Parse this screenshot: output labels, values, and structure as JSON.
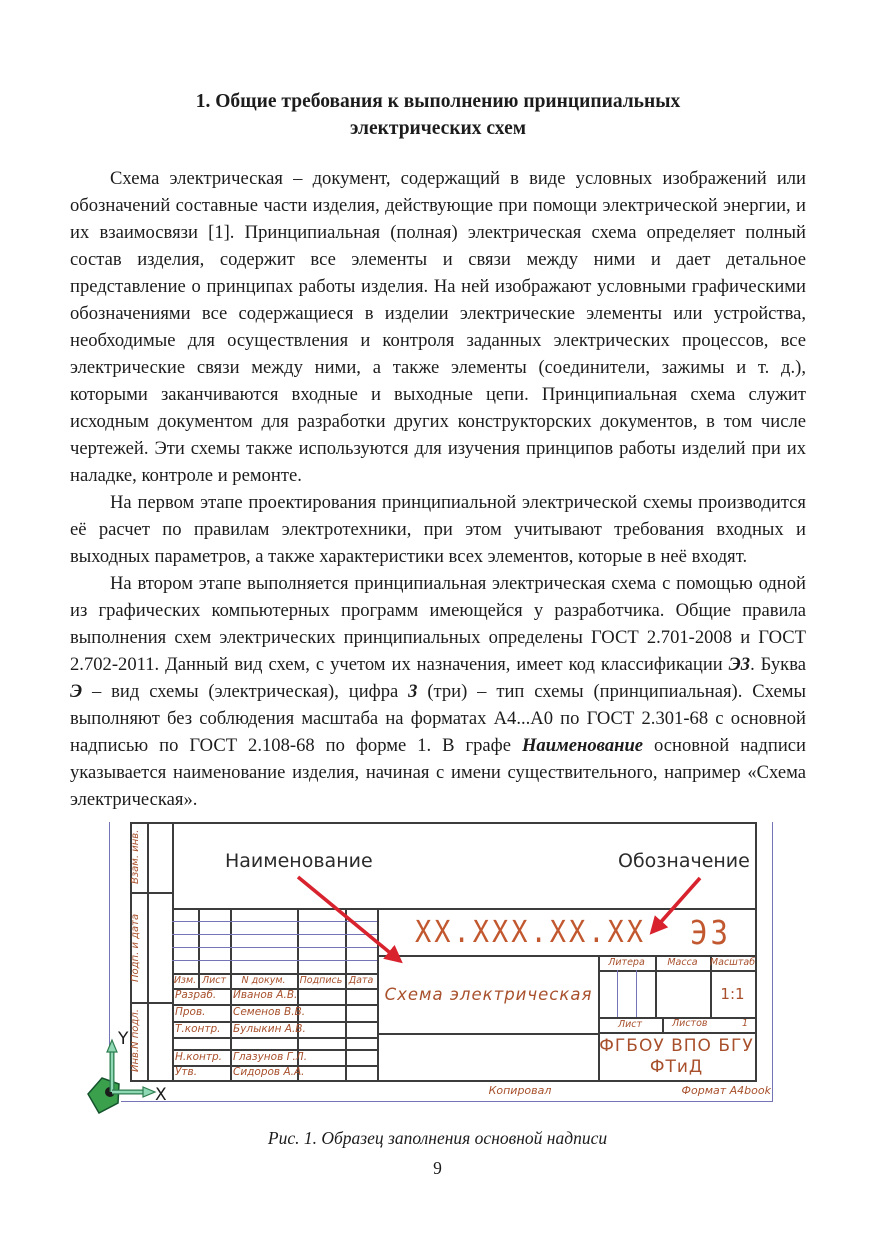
{
  "page": {
    "number": "9"
  },
  "title": {
    "line1": "1. Общие требования к выполнению принципиальных",
    "line2": "электрических схем"
  },
  "paragraphs": {
    "p1": "Схема электрическая – документ, содержащий в виде условных изображений или обозначений составные части изделия, действующие при помощи электрической энергии, и их взаимосвязи [1]. Принципиальная (полная) электрическая схема определяет полный состав изделия, содержит все элементы и связи между ними и дает детальное представление о принципах работы изделия. На ней изображают условными графическими обозначениями все содержащиеся в изделии электрические элементы или устройства, необходимые для осуществления и контроля заданных электрических процессов, все электрические связи между ними, а также элементы (соединители, зажимы и т. д.), которыми заканчиваются входные и выходные цепи. Принципиальная схема служит исходным документом для разработки других конструкторских документов, в том числе чертежей. Эти схемы также используются для изучения принципов работы изделий при их наладке, контроле и ремонте.",
    "p2": "На первом этапе проектирования принципиальной электрической схемы производится её расчет по правилам электротехники, при этом учитывают требования входных и выходных параметров, а также характеристики всех элементов, которые в неё входят.",
    "p3": {
      "part1": "На втором этапе выполняется принципиальная электрическая схема с помощью одной из графических компьютерных программ имеющейся у разработчика. Общие правила выполнения схем электрических принципиальных определены ГОСТ 2.701-2008 и ГОСТ 2.702-2011. Данный вид схем, с учетом их назначения, имеет код классификации ",
      "b1": "Э3",
      "part2": ". Буква ",
      "b2": "Э",
      "part3": " – вид схемы (электрическая), цифра ",
      "b3": "3",
      "part4": " (три) – тип схемы (принципиальная). Схемы выполняют без соблюдения масштаба на форматах А4...А0 по ГОСТ 2.301-68 с основной надписью по ГОСТ 2.108-68 по форме 1. В графе ",
      "b4": "Наименование",
      "part5": " основной надписи указывается наименование изделия, начиная с имени существительного, например «Схема электрическая»."
    }
  },
  "figure": {
    "caption": "Рис. 1. Образец заполнения основной надписи",
    "callouts": {
      "name": "Наименование",
      "designation": "Обозначение"
    },
    "axis": {
      "x": "X",
      "y": "Y"
    },
    "margin_columns": [
      "Взам. инв.",
      "Подп. и дата",
      "Инв.N подл."
    ],
    "title_block": {
      "designation": "XX.XXX.XX.XX",
      "doc_code": "Э3",
      "product_name": "Схема  электрическая",
      "header": [
        "Изм.",
        "Лист",
        "N докум.",
        "Подпись",
        "Дата"
      ],
      "rows": [
        [
          "Разраб.",
          "Иванов А.В."
        ],
        [
          "Пров.",
          "Семенов В.В."
        ],
        [
          "Т.контр.",
          "Булыкин А.В."
        ],
        [
          "",
          ""
        ],
        [
          "Н.контр.",
          "Глазунов Г.Л."
        ],
        [
          "Утв.",
          "Сидоров А.А."
        ]
      ],
      "litera_label": "Литера",
      "mass_label": "Масса",
      "scale_label": "Масштаб",
      "scale_value": "1:1",
      "sheet_label": "Лист",
      "sheets_label": "Листов",
      "sheets_value": "1",
      "organization_line1": "ФГБОУ ВПО БГУ",
      "organization_line2": "ФТиД",
      "copied_label": "Копировал",
      "format_label": "Формат А4book"
    },
    "colors": {
      "arrow_red": "#d8232e",
      "cad_text": "#a8502c",
      "designation_text": "#c2582f",
      "thin_line_blue": "#7474b6",
      "frame_dark": "#3c3c3c",
      "axis_green": "#3ba04c",
      "axis_arrow_mint": "#8fd8b4"
    }
  }
}
